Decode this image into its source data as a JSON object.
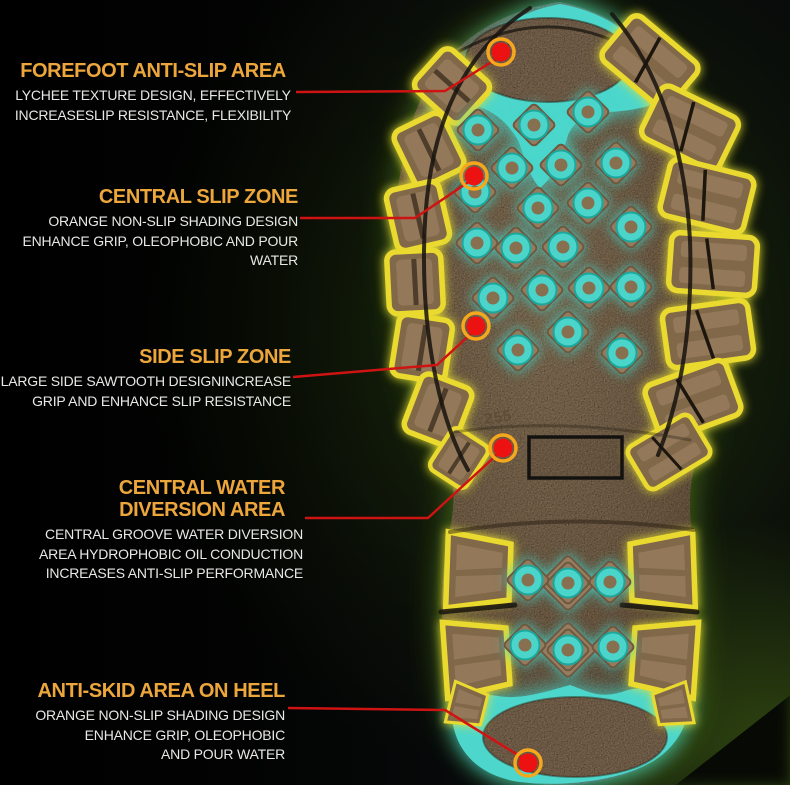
{
  "annotations": [
    {
      "id": "forefoot",
      "title_lines": [
        "FOREFOOT ANTI-SLIP AREA"
      ],
      "lines": [
        "LYCHEE TEXTURE DESIGN, EFFECTIVELY",
        "INCREASESLIP RESISTANCE, FLEXIBILITY"
      ]
    },
    {
      "id": "central-slip",
      "title_lines": [
        "CENTRAL SLIP ZONE"
      ],
      "lines": [
        "ORANGE NON-SLIP SHADING DESIGN",
        "ENHANCE GRIP, OLEOPHOBIC AND POUR WATER"
      ]
    },
    {
      "id": "side-slip",
      "title_lines": [
        "SIDE SLIP ZONE"
      ],
      "lines": [
        "LARGE SIDE SAWTOOTH DESIGNINCREASE",
        "GRIP AND ENHANCE SLIP RESISTANCE"
      ]
    },
    {
      "id": "water-diversion",
      "title_lines": [
        "CENTRAL WATER",
        "DIVERSION AREA"
      ],
      "lines": [
        "CENTRAL GROOVE WATER DIVERSION",
        "AREA HYDROPHOBIC OIL CONDUCTION",
        "INCREASES ANTI-SLIP PERFORMANCE"
      ]
    },
    {
      "id": "heel",
      "title_lines": [
        "ANTI-SKID AREA ON HEEL"
      ],
      "lines": [
        "ORANGE NON-SLIP SHADING DESIGN",
        "ENHANCE GRIP, OLEOPHOBIC",
        "AND POUR WATER"
      ]
    }
  ],
  "sole": {
    "size_marking": "255"
  },
  "colors": {
    "title_accent": "#eda63c",
    "body_text": "#e8e8e6",
    "callout_line": "#cf1313",
    "callout_dot": "#ed1212",
    "callout_dot_ring": "#f6a81d",
    "lug_glow_yellow": "#e8e231",
    "traction_cyan": "#4bd5ca",
    "sole_brown": "#9a8165",
    "background_green": "#2a4209"
  }
}
